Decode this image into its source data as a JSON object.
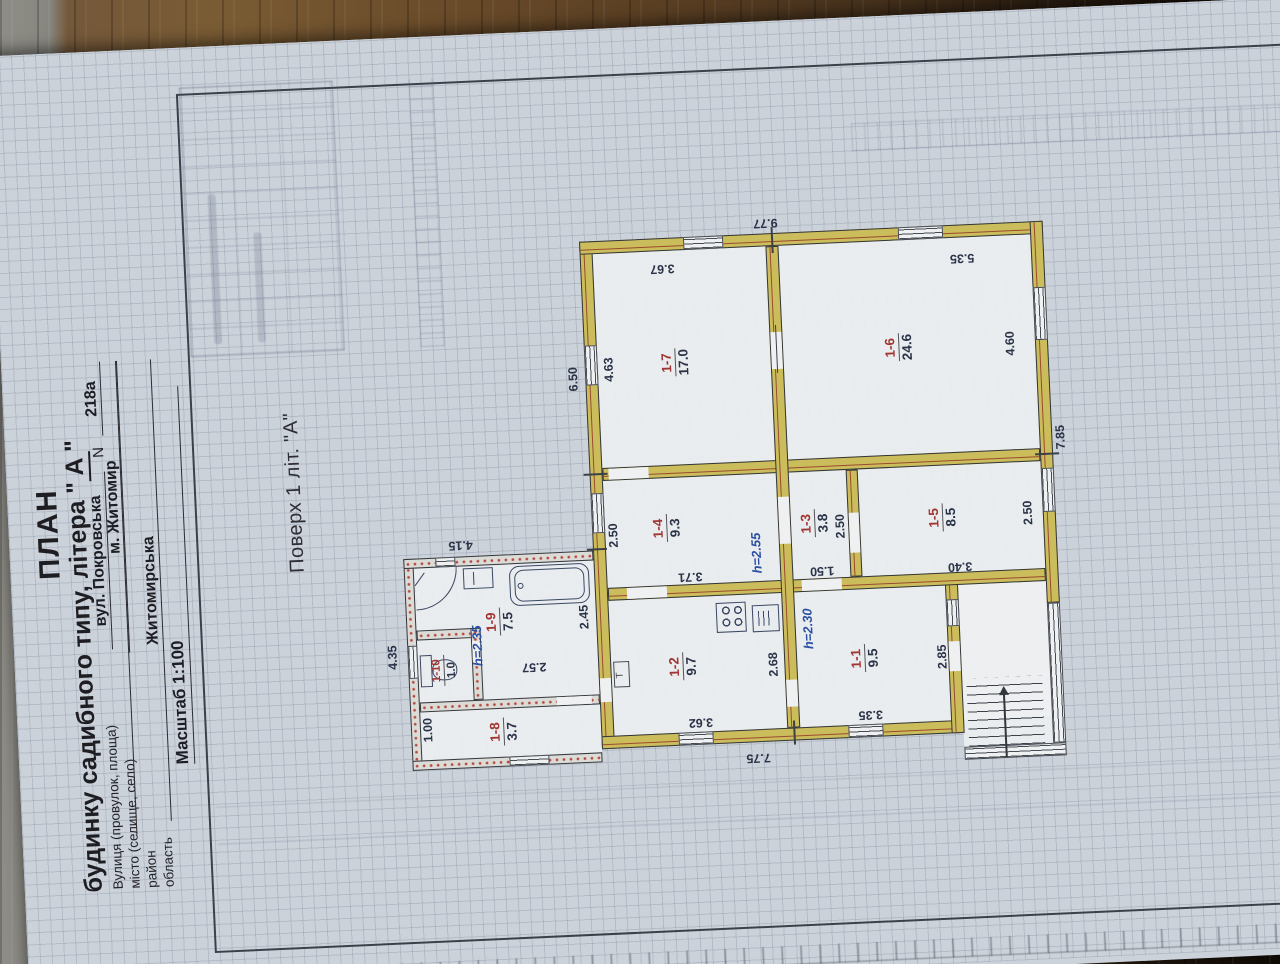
{
  "header": {
    "title": "ПЛАН",
    "subtitle_prefix": "будинку садибного типу, літера \"",
    "subtitle_letter": "А",
    "subtitle_suffix": "\"",
    "fields": [
      {
        "label": "Вулиця (провулок, площа)",
        "value": "вул. Покровська",
        "extra_label": "N",
        "extra_value": "218а"
      },
      {
        "label": "місто (селище, село)",
        "value": "м. Житомир"
      },
      {
        "label": "район",
        "value": ""
      },
      {
        "label": "область",
        "value": "Житомирська"
      }
    ],
    "scale_text": "Масштаб 1:100"
  },
  "plan": {
    "floor_label": "Поверх 1 літ. \"А\"",
    "rooms": [
      {
        "num": "1-1",
        "area": "9.5"
      },
      {
        "num": "1-2",
        "area": "9.7"
      },
      {
        "num": "1-3",
        "area": "3.8"
      },
      {
        "num": "1-4",
        "area": "9.3"
      },
      {
        "num": "1-5",
        "area": "8.5"
      },
      {
        "num": "1-6",
        "area": "24.6"
      },
      {
        "num": "1-7",
        "area": "17.0"
      },
      {
        "num": "1-8",
        "area": "3.7"
      },
      {
        "num": "1-9",
        "area": "7.5"
      },
      {
        "num": "1-10",
        "area": "1.0"
      }
    ],
    "heights": [
      "h=2.35",
      "h=2.55",
      "h=2.30"
    ],
    "dimensions": [
      "9.77",
      "7.75",
      "7.85",
      "6.50",
      "4.63",
      "3.67",
      "5.35",
      "4.60",
      "2.50",
      "3.71",
      "2.50",
      "1.50",
      "2.50",
      "3.40",
      "2.68",
      "3.62",
      "2.85",
      "3.35",
      "4.35",
      "4.15",
      "1.00",
      "2.57",
      "2.45"
    ]
  },
  "colors": {
    "wall_main": "#cbbd5b",
    "wall_accent_line": "#9b4a2f",
    "wall_annex": "#dbdbd7",
    "annex_speckle": "#b2382c",
    "room_number": "#a13531",
    "dimension_text": "#2a3347",
    "height_text": "#2b4fa3",
    "paper": "#ccd2da",
    "frame": "#3b4049"
  }
}
